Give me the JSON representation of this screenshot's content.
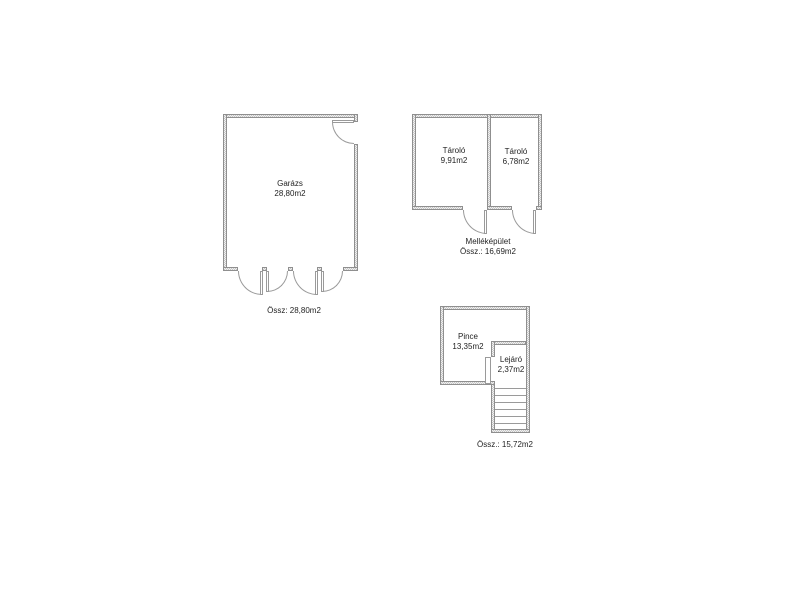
{
  "colors": {
    "background": "#ffffff",
    "wall_border": "#8f8f8f",
    "wall_hatch": "#c6c6c6",
    "wall_fill": "#f0f0f0",
    "line": "#9a9a9a",
    "text": "#1f1f1f"
  },
  "garage": {
    "name": "Garázs",
    "area": "28,80m2",
    "summary": "Össz: 28,80m2"
  },
  "outbuilding": {
    "title": "Melléképület",
    "summary": "Össz.: 16,69m2",
    "rooms": [
      {
        "name": "Tároló",
        "area": "9,91m2"
      },
      {
        "name": "Tároló",
        "area": "6,78m2"
      }
    ]
  },
  "cellar": {
    "main": {
      "name": "Pince",
      "area": "13,35m2"
    },
    "stair": {
      "name": "Lejáró",
      "area": "2,37m2"
    },
    "summary": "Össz.: 15,72m2"
  }
}
